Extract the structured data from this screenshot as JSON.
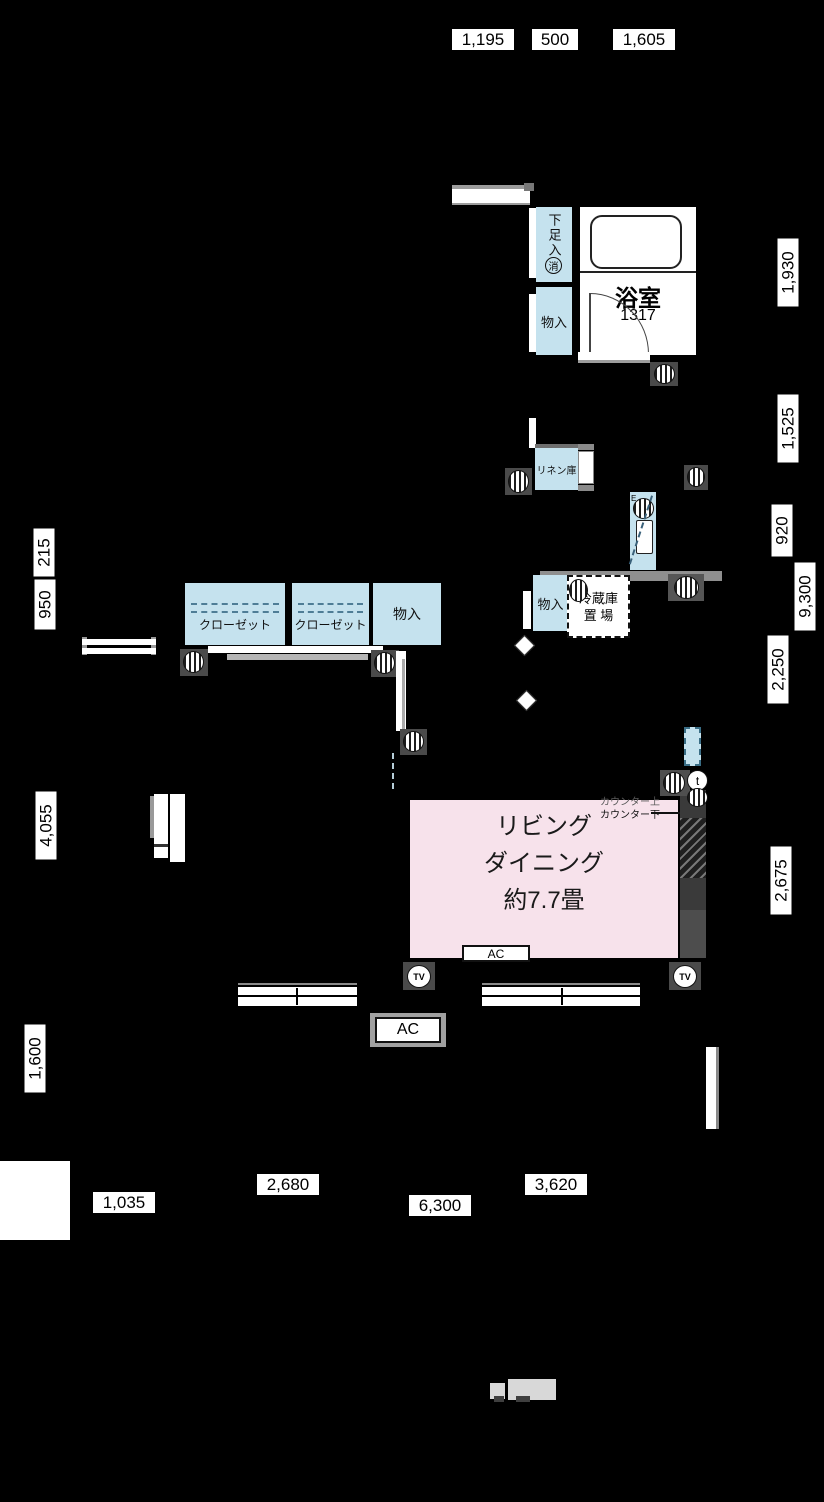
{
  "dims": {
    "top": [
      "1,195",
      "500",
      "1,605"
    ],
    "right": [
      "1,930",
      "1,525",
      "920",
      "9,300",
      "2,250",
      "2,675"
    ],
    "left": [
      "215",
      "950",
      "4,055",
      "1,600"
    ],
    "bottom": [
      "2,680",
      "3,620",
      "1,035",
      "6,300"
    ]
  },
  "labels": {
    "shoe": "下足入",
    "fire": "消",
    "bath": "浴室",
    "bath_size": "1317",
    "storage": "物入",
    "linen": "リネン庫",
    "fridge1": "冷蔵庫",
    "fridge2": "置 場",
    "closet": "クローゼット",
    "living1": "リビング",
    "living2": "ダイニング",
    "living3": "約7.7畳",
    "counter_up": "カウンター上",
    "counter_down": "カウンター下",
    "ac": "AC",
    "tv": "TV",
    "t": "t",
    "e": "E"
  },
  "colors": {
    "storage_fill": "#c5e2ee",
    "living_fill": "#f7e2eb",
    "wall_gray": "#3a3a3a",
    "background": "#000000"
  }
}
